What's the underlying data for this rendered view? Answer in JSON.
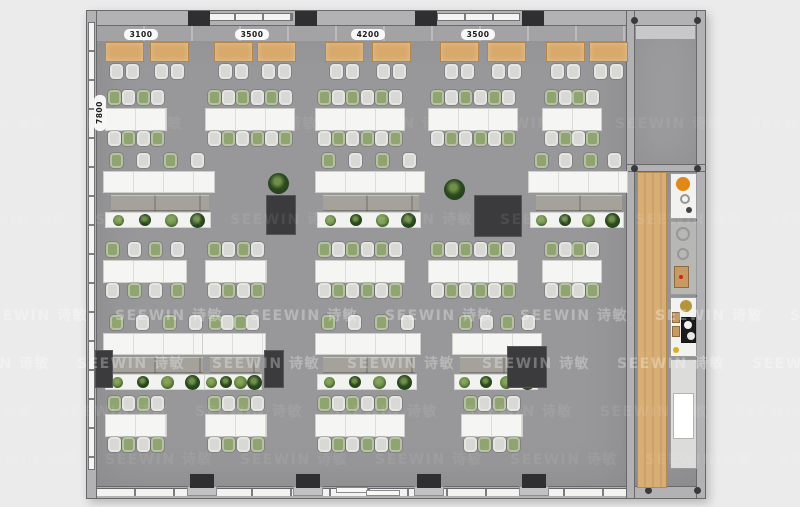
{
  "watermark": {
    "text": "SEEWIN 诗敏",
    "step": 135,
    "rows": [
      {
        "y": 305,
        "x0": -20,
        "opacity": 0.3
      },
      {
        "y": 353,
        "x0": -58,
        "opacity": 0.3
      },
      {
        "y": 209,
        "x0": -40,
        "opacity": 0.08
      },
      {
        "y": 401,
        "x0": -75,
        "opacity": 0.08
      },
      {
        "y": 113,
        "x0": -60,
        "opacity": 0.07
      },
      {
        "y": 449,
        "x0": -30,
        "opacity": 0.07
      }
    ]
  },
  "dimensions": {
    "top": [
      {
        "label": "3100",
        "cx": 141
      },
      {
        "label": "3500",
        "cx": 252
      },
      {
        "label": "4200",
        "cx": 368
      },
      {
        "label": "3500",
        "cx": 478
      }
    ],
    "left": {
      "label": "7800",
      "x": 94,
      "y": 95
    }
  },
  "colors": {
    "chair_gray": "#d8d8d4",
    "chair_green": "#8fa471",
    "plant_dark1": "#2c4a20",
    "plant_dark2": "#1f3a18",
    "plant_light": "#6f8f4a",
    "appliance_orange": "#e08818",
    "appliance_gold": "#b5953c",
    "burner_white": "#f2f2f2",
    "dot_yellow": "#d8b021",
    "dot_red": "#cc2222",
    "wood_box": "#c89a62",
    "cooktop_black": "#1c1c1e"
  },
  "top_tables": {
    "y": 42,
    "w": 39,
    "h": 20,
    "chair_y": 64,
    "xs": [
      105,
      150,
      214,
      257,
      325,
      372,
      440,
      487,
      546,
      589
    ]
  },
  "columns": {
    "top_xs": [
      188,
      295,
      415,
      522
    ],
    "bottom_xs": [
      190,
      296,
      417,
      522
    ]
  },
  "cluster_rows": [
    {
      "y": 90,
      "clusters": [
        {
          "x": 105,
          "w": 62,
          "n": 4
        },
        {
          "x": 205,
          "w": 90,
          "n": 6
        },
        {
          "x": 315,
          "w": 90,
          "n": 6
        },
        {
          "x": 428,
          "w": 90,
          "n": 6
        },
        {
          "x": 542,
          "w": 60,
          "n": 4
        }
      ]
    },
    {
      "y": 242,
      "clusters": [
        {
          "x": 103,
          "w": 84,
          "n": 4
        },
        {
          "x": 205,
          "w": 62,
          "n": 4
        },
        {
          "x": 315,
          "w": 90,
          "n": 6
        },
        {
          "x": 428,
          "w": 90,
          "n": 6
        },
        {
          "x": 542,
          "w": 60,
          "n": 4
        }
      ]
    },
    {
      "y": 396,
      "clusters": [
        {
          "x": 105,
          "w": 62,
          "n": 4
        },
        {
          "x": 205,
          "w": 62,
          "n": 4
        },
        {
          "x": 315,
          "w": 90,
          "n": 6
        },
        {
          "x": 461,
          "w": 62,
          "n": 4
        }
      ]
    }
  ],
  "bench_rows": [
    {
      "y": 153,
      "groups": [
        {
          "x": 103,
          "w": 112
        },
        {
          "x": 315,
          "w": 110
        },
        {
          "x": 528,
          "w": 100
        }
      ],
      "cabinets": [
        {
          "x": 266,
          "y": 195,
          "w": 30,
          "h": 40
        },
        {
          "x": 474,
          "y": 195,
          "w": 48,
          "h": 42
        }
      ],
      "free_plants": [
        {
          "x": 268,
          "y": 173
        },
        {
          "x": 444,
          "y": 179
        }
      ]
    },
    {
      "y": 315,
      "groups": [
        {
          "x": 103,
          "w": 106
        },
        {
          "x": 202,
          "w": 64
        },
        {
          "x": 315,
          "w": 106
        },
        {
          "x": 452,
          "w": 90
        }
      ],
      "cabinets": [
        {
          "x": 95,
          "y": 350,
          "w": 18,
          "h": 38
        },
        {
          "x": 264,
          "y": 350,
          "w": 20,
          "h": 38
        },
        {
          "x": 507,
          "y": 346,
          "w": 40,
          "h": 42
        }
      ],
      "free_plants": []
    }
  ],
  "pantry": {
    "wood_bar": {
      "x": 637,
      "y": 172,
      "w": 30,
      "h": 316
    },
    "counter_x": 670,
    "counter_w": 27,
    "units": [
      {
        "y": 173,
        "h": 46,
        "tone": "#f2f2f0",
        "items": [
          {
            "t": "circle",
            "c": "#e08818",
            "x": 13,
            "y": 11,
            "r": 7
          },
          {
            "t": "ring",
            "x": 15,
            "y": 26,
            "r": 5
          },
          {
            "t": "circle",
            "c": "#444446",
            "x": 19,
            "y": 37,
            "r": 3
          }
        ]
      },
      {
        "y": 221,
        "h": 74,
        "tone": "#b7b7b4",
        "items": [
          {
            "t": "ring",
            "x": 13,
            "y": 13,
            "r": 7
          },
          {
            "t": "ring",
            "x": 13,
            "y": 33,
            "r": 6
          },
          {
            "t": "box",
            "c": "#c89a62",
            "x": 4,
            "y": 45,
            "w": 15,
            "h": 22
          },
          {
            "t": "circle",
            "c": "#cc2222",
            "x": 11,
            "y": 56,
            "r": 2
          }
        ]
      },
      {
        "y": 297,
        "h": 60,
        "tone": "#f2f2f0",
        "items": [
          {
            "t": "circle",
            "c": "#b5953c",
            "x": 16,
            "y": 9,
            "r": 6
          },
          {
            "t": "box",
            "c": "#c89a62",
            "x": 2,
            "y": 15,
            "w": 8,
            "h": 11
          },
          {
            "t": "box",
            "c": "#c89a62",
            "x": 2,
            "y": 29,
            "w": 8,
            "h": 11
          },
          {
            "t": "box",
            "c": "#1c1c1e",
            "x": 11,
            "y": 20,
            "w": 15,
            "h": 26
          },
          {
            "t": "circle",
            "c": "#f2f2f2",
            "x": 18,
            "y": 28,
            "r": 4
          },
          {
            "t": "circle",
            "c": "#e8e8e8",
            "x": 21,
            "y": 39,
            "r": 4
          },
          {
            "t": "circle",
            "c": "#d8b021",
            "x": 6,
            "y": 53,
            "r": 3
          }
        ]
      },
      {
        "y": 359,
        "h": 110,
        "tone": "#dcdcda",
        "items": [
          {
            "t": "box",
            "c": "#ffffff",
            "x": 3,
            "y": 34,
            "w": 21,
            "h": 46
          }
        ]
      }
    ]
  }
}
